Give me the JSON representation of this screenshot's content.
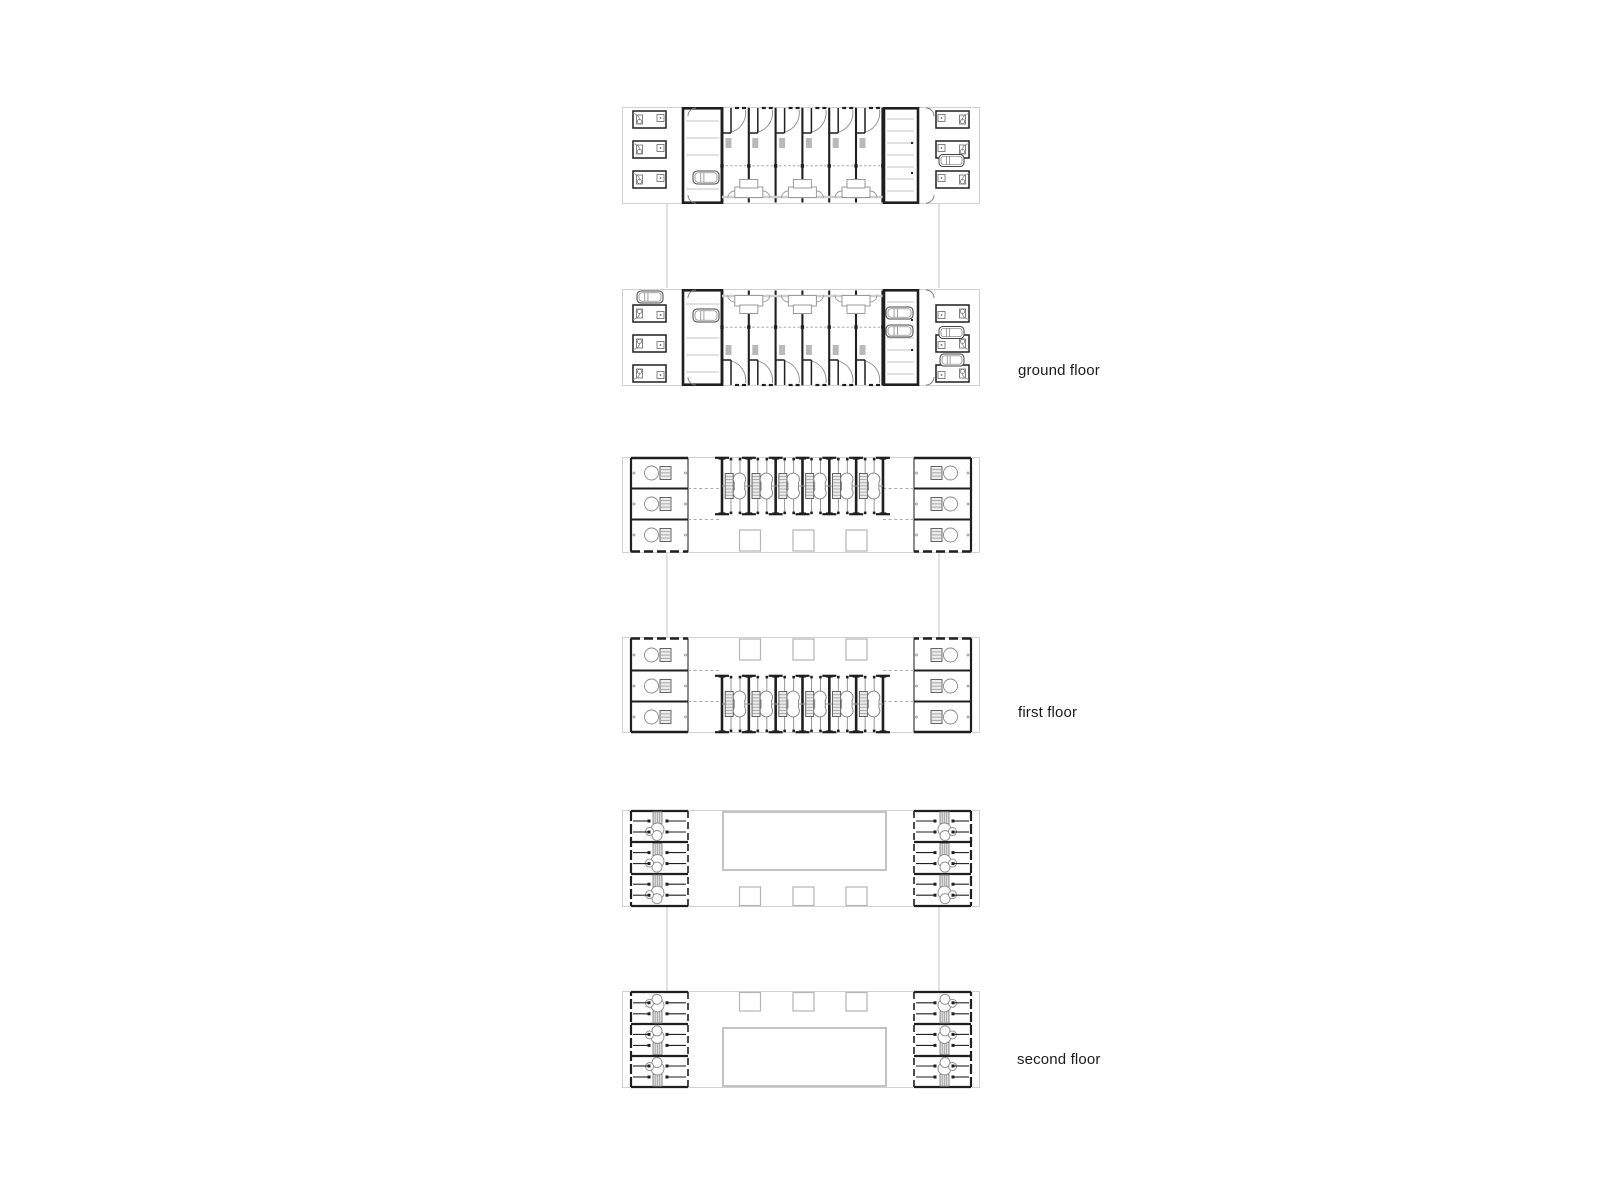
{
  "page": {
    "background": "#ffffff"
  },
  "labels": {
    "ground": {
      "text": "ground floor",
      "x": 1018,
      "y": 363
    },
    "first": {
      "text": "first floor",
      "x": 1018,
      "y": 705
    },
    "second": {
      "text": "second floor",
      "x": 1017,
      "y": 1052
    }
  },
  "plans": {
    "bar_x": 622,
    "bar_w": 358,
    "colors": {
      "wall": "#1f1f1f",
      "light": "#c3c3c3",
      "faint": "#cccccc",
      "mid": "#8a8a8a",
      "band": "#cfcfcf",
      "duct": "#b9b9b9"
    },
    "floors": [
      {
        "id": "ground",
        "type": "ground",
        "label_key": "ground",
        "center_units": 6,
        "wing_rooms": 3,
        "bars": [
          {
            "y": 107,
            "h": 97,
            "flip": false
          },
          {
            "y": 288,
            "h": 98,
            "flip": true
          }
        ],
        "connector": {
          "xs": [
            667,
            939
          ],
          "y1": 204,
          "y2": 288
        },
        "extra_cars": [
          [
            637,
            291,
            26,
            12
          ],
          [
            886,
            307,
            27,
            12
          ],
          [
            886,
            325,
            27,
            12
          ],
          [
            940,
            354,
            24,
            12
          ]
        ]
      },
      {
        "id": "first",
        "type": "first",
        "label_key": "first",
        "center_units": 6,
        "wing_rooms": 3,
        "bars": [
          {
            "y": 457,
            "h": 96,
            "flip": false
          },
          {
            "y": 637,
            "h": 96,
            "flip": true
          }
        ],
        "connector": {
          "xs": [
            667,
            939
          ],
          "y1": 553,
          "y2": 637
        },
        "extra_cars": []
      },
      {
        "id": "second",
        "type": "second",
        "label_key": "second",
        "center_units": 6,
        "wing_rooms": 3,
        "bars": [
          {
            "y": 810,
            "h": 97,
            "flip": false
          },
          {
            "y": 991,
            "h": 97,
            "flip": true
          }
        ],
        "connector": {
          "xs": [
            667,
            939
          ],
          "y1": 907,
          "y2": 991
        },
        "extra_cars": []
      }
    ]
  }
}
